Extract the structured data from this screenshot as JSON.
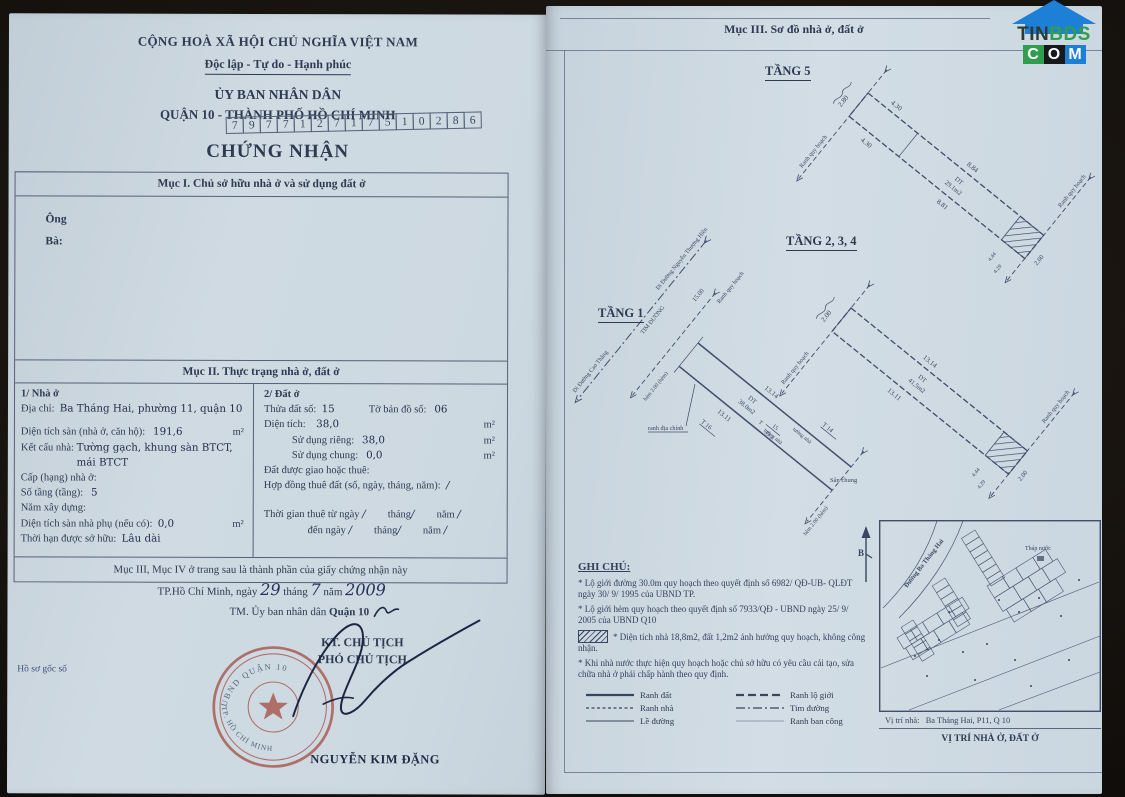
{
  "logo": {
    "tin": "TIN",
    "bds": "BDS",
    "c": "C",
    "o": "O",
    "m": "M"
  },
  "left_page": {
    "header": {
      "country": "CỘNG HOÀ XÃ HỘI CHỦ NGHĨA VIỆT NAM",
      "motto": "Độc lập - Tự do - Hạnh phúc",
      "committee": "ỦY BAN NHÂN DÂN",
      "district": "QUẬN 10 - THÀNH PHỐ HỒ CHÍ MINH"
    },
    "serial": [
      "7",
      "9",
      "7",
      "7",
      "1",
      "2",
      "7",
      "1",
      "7",
      "5",
      "1",
      "0",
      "2",
      "8",
      "6"
    ],
    "title": "CHỨNG NHẬN",
    "section1": {
      "header": "Mục I. Chủ sở hữu nhà ở và sử dụng đất ở",
      "mr": "Ông",
      "mrs": "Bà:"
    },
    "section2": {
      "header": "Mục II. Thực trạng nhà ở, đất ở",
      "house": {
        "title": "1/ Nhà ở",
        "address_label": "Địa chỉ:",
        "address": "Ba Tháng Hai, phường 11, quận 10",
        "floor_area_label": "Diện tích sàn (nhà ở, căn hộ):",
        "floor_area": "191,6",
        "unit_m2": "m²",
        "structure_label": "Kết cấu nhà:",
        "structure": "Tường gạch, khung sàn BTCT, mái BTCT",
        "grade_label": "Cấp (hạng) nhà ở:",
        "floors_label": "Số tầng (tầng):",
        "floors": "5",
        "year_label": "Năm xây dựng:",
        "aux_label": "Diện tích sàn nhà phụ (nếu có):",
        "aux": "0,0",
        "tenure_label": "Thời hạn được sở hữu:",
        "tenure": "Lâu dài"
      },
      "land": {
        "title": "2/ Đất ở",
        "parcel_label": "Thửa đất số:",
        "parcel": "15",
        "sheet_label": "Tờ bản đồ số:",
        "sheet": "06",
        "area_label": "Diện tích:",
        "area": "38,0",
        "unit_m2": "m²",
        "private_label": "Sử dụng riêng:",
        "private": "38,0",
        "shared_label": "Sử dụng chung:",
        "shared": "0,0",
        "alloc_label": "Đất được giao hoặc thuê:",
        "lease_label": "Hợp đồng thuê đất (số, ngày, tháng, năm):",
        "slash": "/",
        "from_label": "Thời gian thuê từ ngày",
        "to_label": "đến ngày",
        "month_label": "tháng",
        "year_label": "năm"
      }
    },
    "footer_note": "Mục III, Mục IV ở trang sau là thành phần của giấy chứng nhận này",
    "sign": {
      "place": "TP.Hồ Chí Minh",
      "date_prefix": ", ngày",
      "day": "29",
      "month_label": "tháng",
      "month": "7",
      "year_label": "năm",
      "year": "2009",
      "tm": "TM. Ủy ban nhân dân",
      "district": "Quận 10",
      "kt": "KT. CHỦ TỊCH",
      "deputy": "PHÓ CHỦ TỊCH",
      "signer": "NGUYỄN KIM ĐẶNG",
      "dossier": "Hồ sơ gốc số",
      "stamp_top": "UBND QUẬN 10",
      "stamp_bottom": "TP. HỒ CHÍ MINH"
    }
  },
  "right_page": {
    "header": "Mục III. Sơ đồ nhà ở, đất ở",
    "ranh_quy_hoach": "Ranh quy hoạch",
    "floor5": {
      "title": "TẦNG 5",
      "d_280": "2.80",
      "d_430a": "4.30",
      "d_430b": "4.30",
      "d_884": "8.84",
      "d_881": "8.81",
      "area_label": "DT",
      "area": "29.1m2",
      "d_200": "2.00",
      "d_444": "4.44",
      "d_429": "4.29"
    },
    "floor234": {
      "title": "TẦNG 2, 3, 4",
      "d_200a": "2.00",
      "d_1314": "13.14",
      "d_1311": "13.11",
      "area_label": "DT",
      "area": "41,5m2",
      "d_200b": "2.00",
      "d_444": "4.44",
      "d_429": "4.29"
    },
    "floor1": {
      "title": "TẦNG 1",
      "road_cao_thang": "Đi Đường Cao Thắng",
      "road_nguyen": "Đi Đường Nguyễn Thượng Hiền",
      "tim_duong": "TIM ĐƯỜNG",
      "d_1500": "15.00",
      "hem_front": "hẻm 2.00 (hẻm)",
      "hem_back": "hẻm 2.00 (hẻm)",
      "d_1314": "13.14",
      "d_1311": "13.11",
      "area_label": "DT",
      "area": "38.0m2",
      "t": "T",
      "t15_num": "15",
      "t15_area": "39.2",
      "t14": "T 14",
      "t16": "T 16",
      "wall": "tường nhà",
      "ranh_dia_chinh": "ranh địa chính",
      "san_chung": "Sân chung"
    },
    "notes": {
      "title": "GHI CHÚ:",
      "n1": "* Lộ giới đường 30.0m quy hoạch theo quyết định số 6982/ QĐ-UB- QLĐT ngày 30/ 9/ 1995 của UBND TP.",
      "n2": "* Lộ giới hẻm quy hoạch theo quyết định số 7933/QĐ - UBND ngày 25/ 9/ 2005 của UBND Q10",
      "n3": "* Diện tích nhà 18,8m2, đất 1,2m2 ảnh hưởng quy hoạch, không công nhận.",
      "n4": "* Khi nhà nước thực hiện quy hoạch hoặc chủ sở hữu có yêu cầu cải tạo, sửa chữa nhà ở phải chấp hành theo quy định."
    },
    "legend": {
      "items": [
        "Ranh đất",
        "Ranh lộ giới",
        "Ranh nhà",
        "Tim đường",
        "Lề đường",
        "Ranh ban công"
      ]
    },
    "map": {
      "north": "B",
      "street": "Đường Ba Tháng Hai",
      "tower": "Tháp nước",
      "caption_label": "Vị trí nhà:",
      "caption_value": "Ba Tháng Hai, P11, Q 10",
      "title": "VỊ TRÍ NHÀ Ở, ĐẤT Ở"
    }
  }
}
